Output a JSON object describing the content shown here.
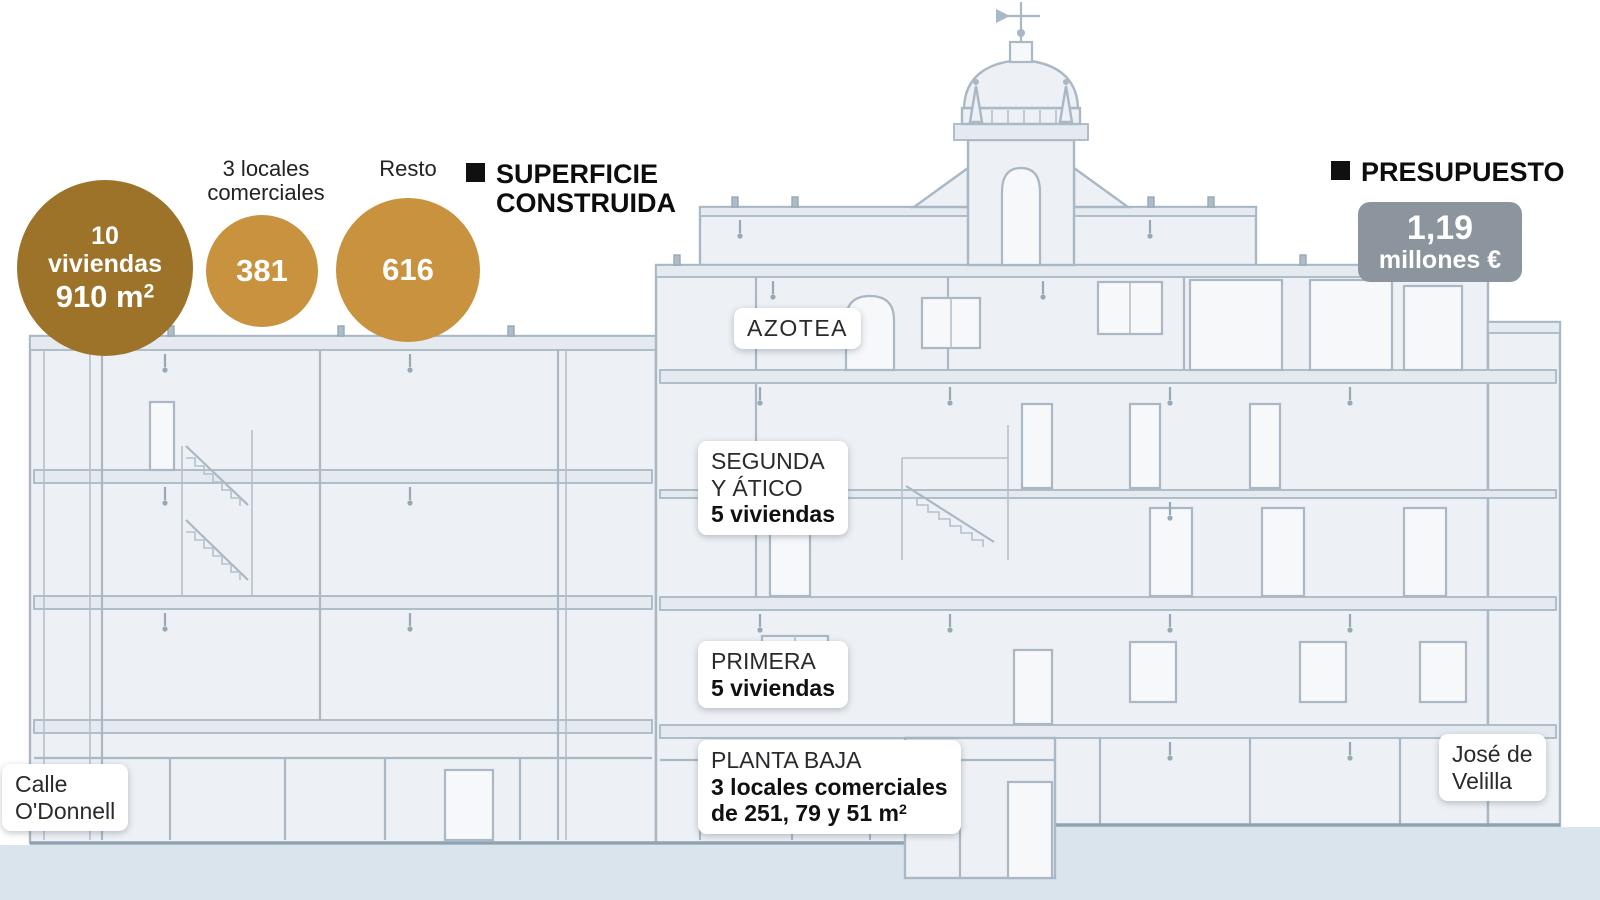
{
  "chart_data": {
    "type": "bubble",
    "title": "SUPERFICIE CONSTRUIDA",
    "series": [
      {
        "label": "10 viviendas",
        "value": 910,
        "unit": "m2"
      },
      {
        "label": "3 locales comerciales",
        "value": 381,
        "unit": "m2"
      },
      {
        "label": "Resto",
        "value": 616,
        "unit": "m2"
      }
    ],
    "annotations": [
      {
        "label": "PRESUPUESTO",
        "value": "1,19 millones €"
      }
    ]
  },
  "legend": {
    "superficie_line1": "SUPERFICIE",
    "superficie_line2": "CONSTRUIDA",
    "presupuesto_title": "PRESUPUESTO",
    "presupuesto_value": "1,19",
    "presupuesto_unit": "millones €"
  },
  "bubbles": {
    "viviendas": {
      "line1": "10",
      "line2": "viviendas",
      "area": "910 m",
      "area_sup": "2"
    },
    "locales": {
      "label_line1": "3 locales",
      "label_line2": "comerciales",
      "value": "381"
    },
    "resto": {
      "label": "Resto",
      "value": "616"
    }
  },
  "floors": {
    "azotea": {
      "name": "AZOTEA"
    },
    "segunda": {
      "name_line1": "SEGUNDA",
      "name_line2": "Y ÁTICO",
      "detail": "5 viviendas"
    },
    "primera": {
      "name": "PRIMERA",
      "detail": "5 viviendas"
    },
    "planta_baja": {
      "name": "PLANTA BAJA",
      "detail1": "3 locales comerciales",
      "detail2": "de 251, 79 y 51 m",
      "detail2_sup": "2"
    }
  },
  "streets": {
    "left_line1": "Calle",
    "left_line2": "O'Donnell",
    "right_line1": "José de",
    "right_line2": "Velilla"
  },
  "colors": {
    "bubble_dark": "#9c7329",
    "bubble_gold": "#c8923e",
    "badge_gray": "#8c959d",
    "ground_band": "#d9e4ed",
    "building_fill": "#edf0f4",
    "building_line": "#a9b8c4"
  }
}
